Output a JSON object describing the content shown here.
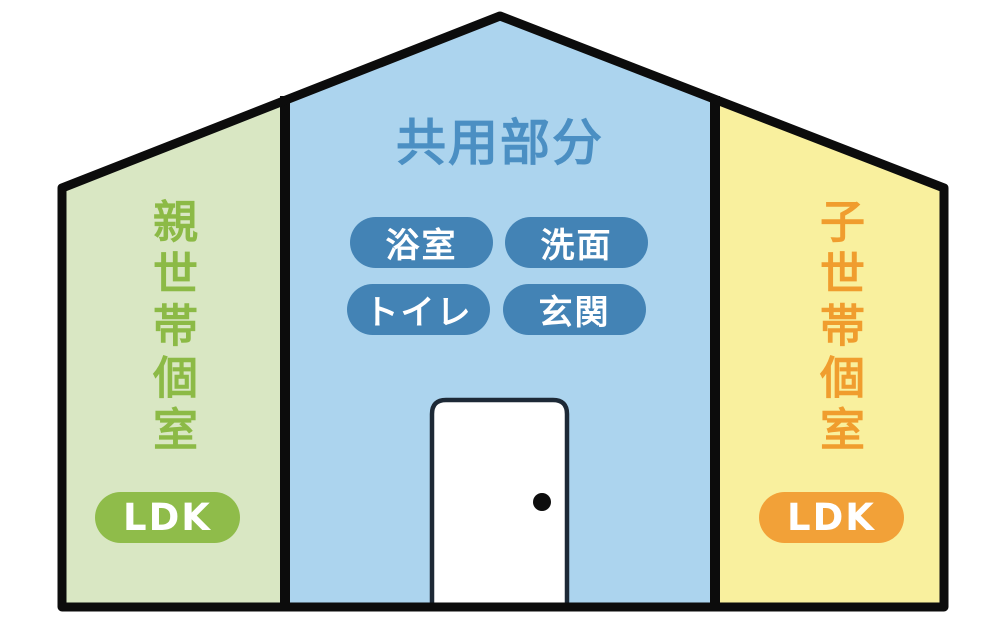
{
  "house": {
    "center": {
      "title": "共用部分",
      "room_badges": [
        {
          "label": "浴室"
        },
        {
          "label": "洗面"
        },
        {
          "label": "トイレ"
        },
        {
          "label": "玄関"
        }
      ]
    },
    "left_unit": {
      "label": "親世帯個室",
      "badge": "LDK"
    },
    "right_unit": {
      "label": "子世帯個室",
      "badge": "LDK"
    },
    "colors": {
      "left_bg": "#d9e7c3",
      "center_bg": "#acd4ee",
      "right_bg": "#f9f09e",
      "outline": "#0c0c0c",
      "room_badge_bg": "#4383b5",
      "center_title_text": "#4b8fc3",
      "left_label_text": "#8cba46",
      "left_badge_bg": "#8fbc4a",
      "right_label_text": "#f09d2e",
      "right_badge_bg": "#f2a138",
      "door_fill": "#ffffff",
      "door_border": "#1d2936"
    }
  }
}
